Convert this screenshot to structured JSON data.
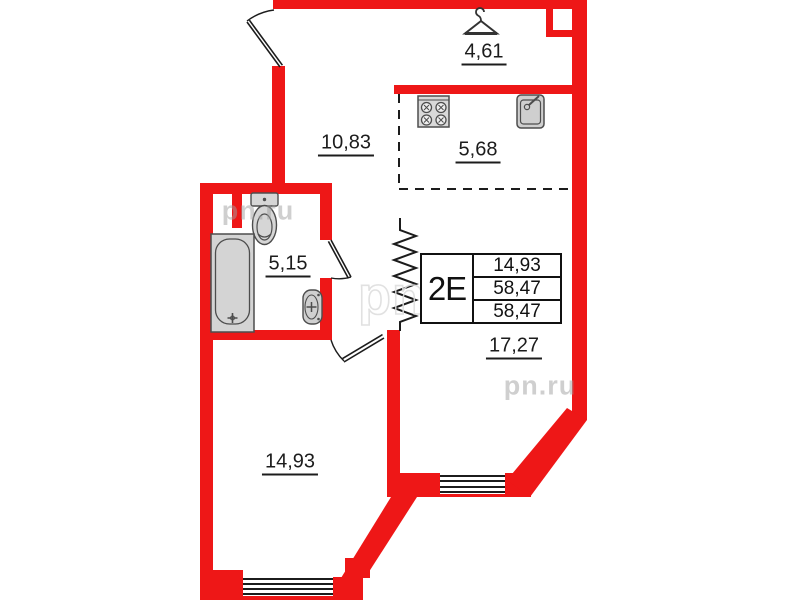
{
  "plan": {
    "areas": {
      "entry_hall": "4,61",
      "hallway": "10,83",
      "kitchen_zone": "5,68",
      "bathroom": "5,15",
      "bedroom": "14,93",
      "living_room": "17,27"
    },
    "info_table": {
      "type_label": "2Е",
      "rows": [
        "14,93",
        "58,47",
        "58,47"
      ]
    },
    "watermarks": {
      "full": "pn.ru",
      "short": "pn"
    },
    "colors": {
      "wall_red": "#ee1717",
      "line_black": "#1c1c1c",
      "fixture_fill": "#d4d4d4",
      "fixture_stroke": "#4d4d4d",
      "watermark_gray": "#a0a0a0"
    }
  }
}
